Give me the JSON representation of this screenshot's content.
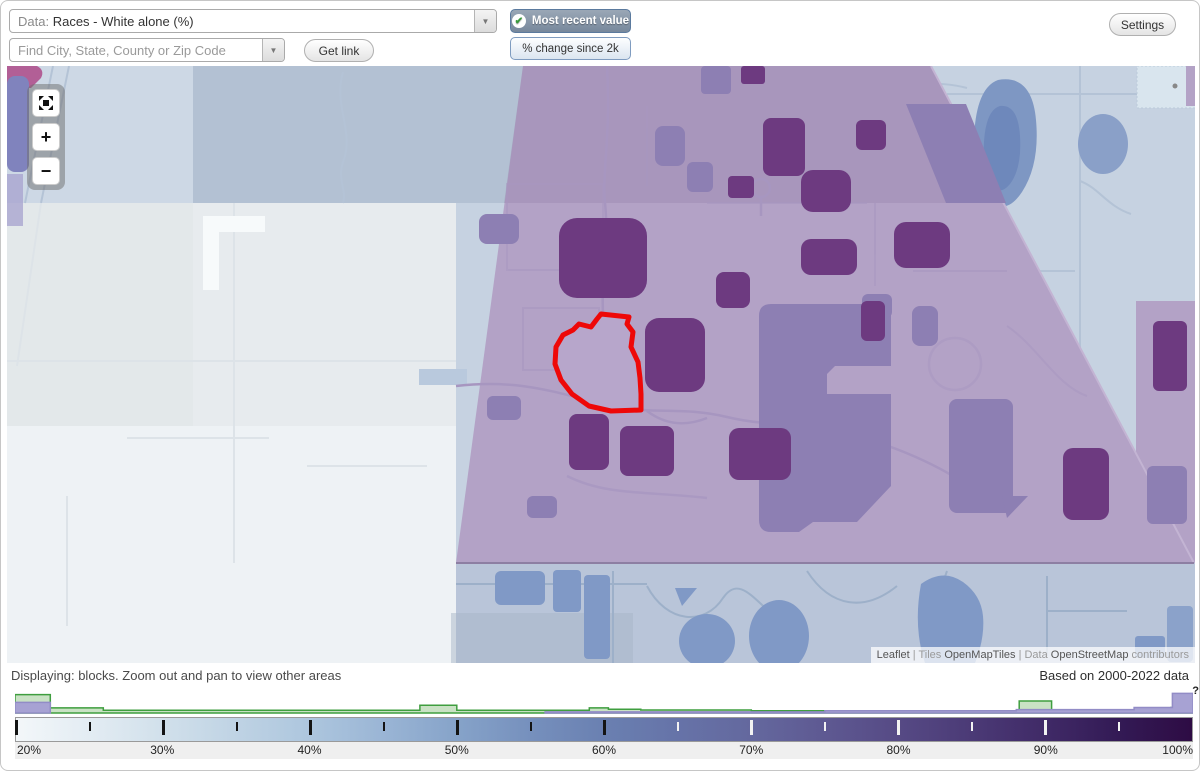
{
  "toolbar": {
    "data_prefix": "Data:",
    "data_value": "Races - White alone (%)",
    "search_placeholder": "Find City, State, County or Zip Code",
    "get_link": "Get link",
    "most_recent_value": "Most recent value",
    "pct_change": "% change since 2k",
    "settings": "Settings"
  },
  "icons": {
    "dropdown_arrow": "▼",
    "check": "✔",
    "zoom_in": "+",
    "zoom_out": "−",
    "help": "?"
  },
  "map": {
    "attribution": {
      "leaflet": "Leaflet",
      "separator": "|",
      "tiles_prefix": "Tiles",
      "tiles_name": "OpenMapTiles",
      "data_prefix": "Data",
      "data_name": "OpenStreetMap",
      "data_suffix": "contributors"
    },
    "colors": {
      "selected_outline": "#ee0808",
      "region_base": "#b3a2c6",
      "block_high": "#6d3a80",
      "block_mid": "#8d7fb3",
      "water": "#7e97c3"
    }
  },
  "status_bar": {
    "displaying": "Displaying: blocks. Zoom out and pan to view other areas",
    "based_on": "Based on 2000-2022 data"
  },
  "legend": {
    "labels": [
      {
        "pct": 20,
        "text": "20%"
      },
      {
        "pct": 30,
        "text": "30%"
      },
      {
        "pct": 40,
        "text": "40%"
      },
      {
        "pct": 50,
        "text": "50%"
      },
      {
        "pct": 60,
        "text": "60%"
      },
      {
        "pct": 70,
        "text": "70%"
      },
      {
        "pct": 80,
        "text": "80%"
      },
      {
        "pct": 90,
        "text": "90%"
      },
      {
        "pct": 100,
        "text": "100%"
      }
    ],
    "ticks": [
      {
        "pct": 20,
        "major": true,
        "light": false
      },
      {
        "pct": 25,
        "major": false,
        "light": false
      },
      {
        "pct": 30,
        "major": true,
        "light": false
      },
      {
        "pct": 35,
        "major": false,
        "light": false
      },
      {
        "pct": 40,
        "major": true,
        "light": false
      },
      {
        "pct": 45,
        "major": false,
        "light": false
      },
      {
        "pct": 50,
        "major": true,
        "light": false
      },
      {
        "pct": 55,
        "major": false,
        "light": false
      },
      {
        "pct": 60,
        "major": true,
        "light": false
      },
      {
        "pct": 65,
        "major": false,
        "light": true
      },
      {
        "pct": 70,
        "major": true,
        "light": true
      },
      {
        "pct": 75,
        "major": false,
        "light": true
      },
      {
        "pct": 80,
        "major": true,
        "light": true
      },
      {
        "pct": 85,
        "major": false,
        "light": true
      },
      {
        "pct": 90,
        "major": true,
        "light": true
      },
      {
        "pct": 95,
        "major": false,
        "light": true
      }
    ],
    "gradient_stops": [
      {
        "pct": 20,
        "color": "#f3f7f9"
      },
      {
        "pct": 25,
        "color": "#e3ecf3"
      },
      {
        "pct": 30,
        "color": "#d1e0eb"
      },
      {
        "pct": 35,
        "color": "#bfd3e4"
      },
      {
        "pct": 40,
        "color": "#adc6de"
      },
      {
        "pct": 45,
        "color": "#9ab5d5"
      },
      {
        "pct": 50,
        "color": "#86a3c9"
      },
      {
        "pct": 55,
        "color": "#7690bd"
      },
      {
        "pct": 60,
        "color": "#6a80b1"
      },
      {
        "pct": 65,
        "color": "#6673a8"
      },
      {
        "pct": 70,
        "color": "#64689e"
      },
      {
        "pct": 75,
        "color": "#5e5992"
      },
      {
        "pct": 80,
        "color": "#564a85"
      },
      {
        "pct": 85,
        "color": "#4b3a76"
      },
      {
        "pct": 90,
        "color": "#402a67"
      },
      {
        "pct": 95,
        "color": "#331a55"
      },
      {
        "pct": 100,
        "color": "#2e0c44"
      }
    ]
  },
  "chart_data": {
    "type": "area",
    "title": "Histogram of census block values along the 20%-100% color scale",
    "x_unit": "percent",
    "x_range": [
      20,
      100
    ],
    "series": [
      {
        "name": "green_outline_histogram",
        "stroke": "#3f9e3f",
        "fill": "#c9e2c4",
        "steps": [
          [
            20,
            22.4,
            0.8
          ],
          [
            22.4,
            26,
            0.22
          ],
          [
            26,
            47.5,
            0.12
          ],
          [
            47.5,
            50,
            0.34
          ],
          [
            50,
            59,
            0.12
          ],
          [
            59,
            60.3,
            0.22
          ],
          [
            60.3,
            62.5,
            0.16
          ],
          [
            62.5,
            70,
            0.13
          ],
          [
            70,
            88.2,
            0.1
          ],
          [
            88.2,
            90.4,
            0.52
          ],
          [
            90.4,
            98.5,
            0.1
          ],
          [
            98.5,
            100,
            0.24
          ]
        ]
      },
      {
        "name": "purple_fill_histogram",
        "stroke": "#928cc6",
        "fill": "#a7a2d3",
        "steps": [
          [
            20,
            22.4,
            0.46
          ],
          [
            56,
            75,
            0.05
          ],
          [
            75,
            88,
            0.1
          ],
          [
            88,
            96,
            0.15
          ],
          [
            96,
            98.6,
            0.24
          ],
          [
            98.6,
            100,
            0.85
          ]
        ]
      }
    ]
  }
}
